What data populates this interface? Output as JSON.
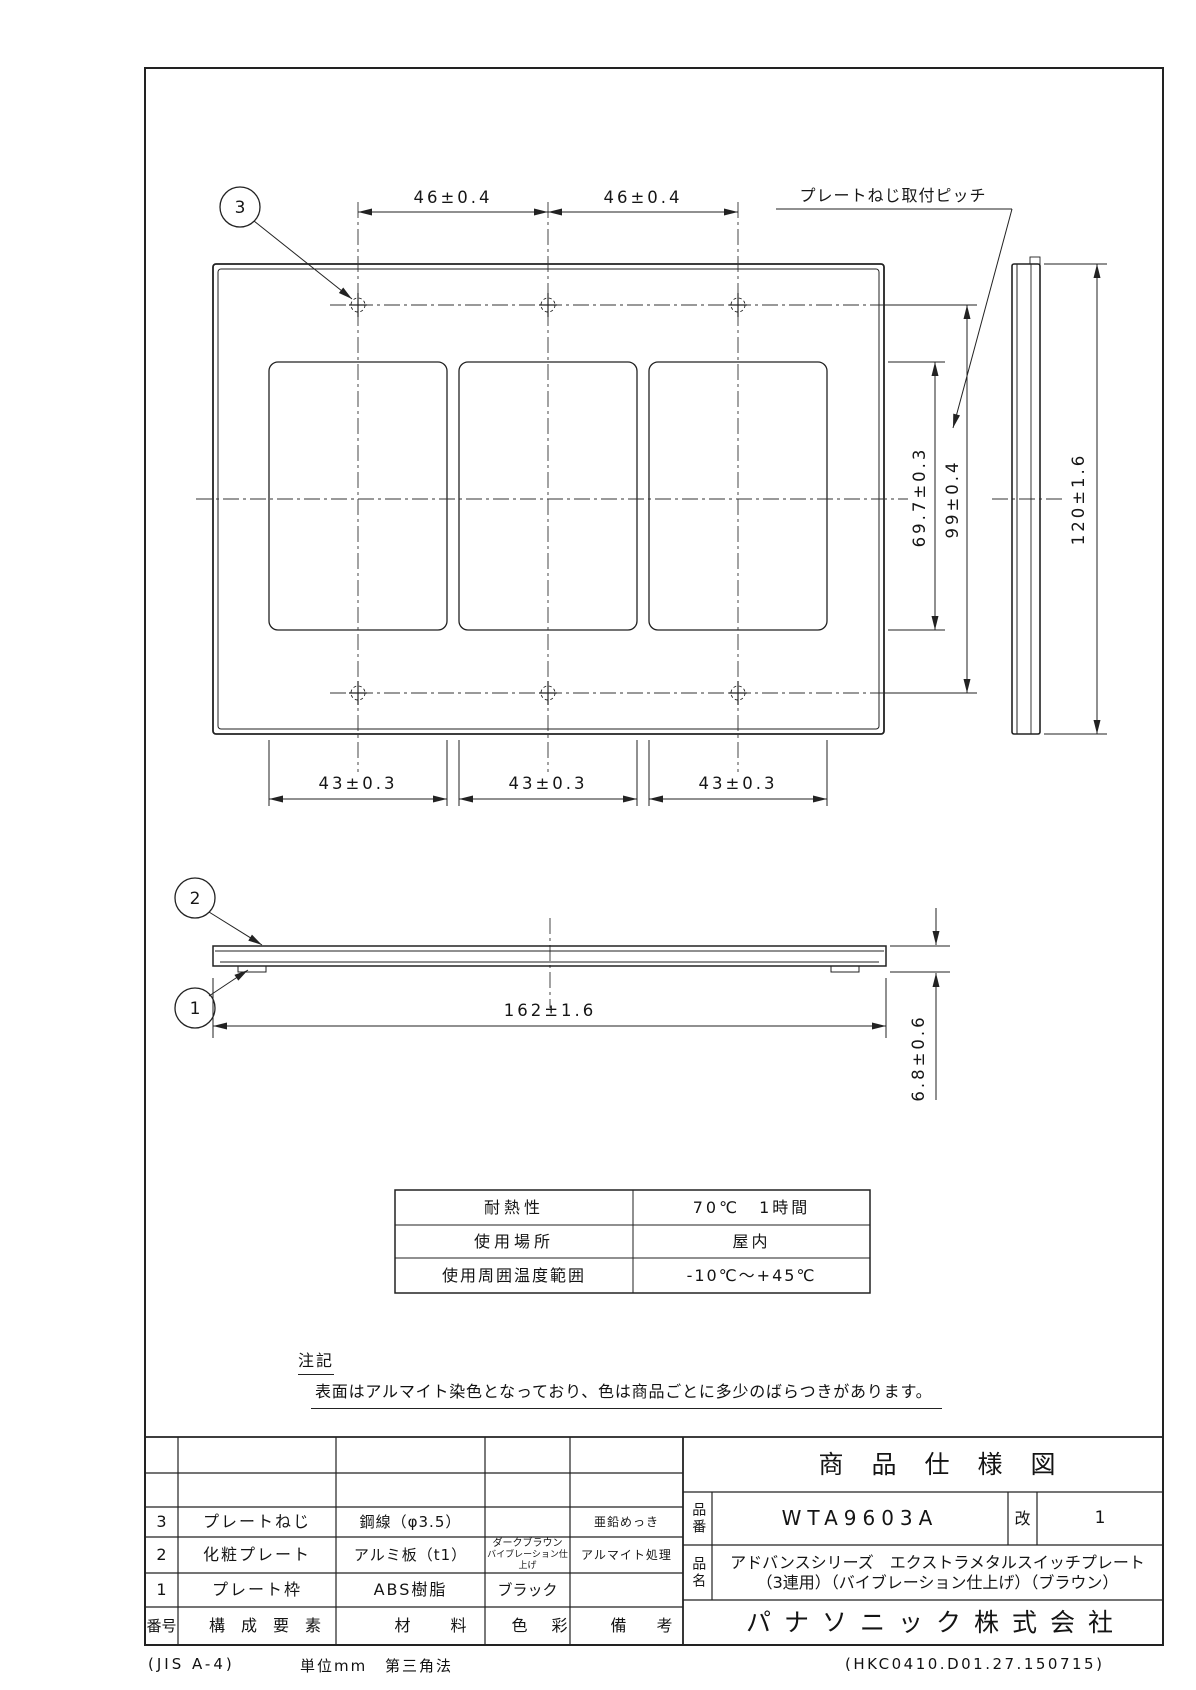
{
  "drawing": {
    "balloons": {
      "b3": "3",
      "b2": "2",
      "b1": "1"
    },
    "dims": {
      "pitch_left": "46±0.4",
      "pitch_right": "46±0.4",
      "screw_pitch_label": "プレートねじ取付ピッチ",
      "opening_height": "69.7±0.3",
      "screw_pitch_v": "99±0.4",
      "plate_height": "120±1.6",
      "opening_w1": "43±0.3",
      "opening_w2": "43±0.3",
      "opening_w3": "43±0.3",
      "plate_width": "162±1.6",
      "thickness": "6.8±0.6"
    }
  },
  "spec_table": {
    "rows": [
      {
        "label": "耐熱性",
        "value": "70℃　1時間"
      },
      {
        "label": "使用場所",
        "value": "屋内"
      },
      {
        "label": "使用周囲温度範囲",
        "value": "-10℃～+45℃"
      }
    ]
  },
  "note": {
    "label": "注記",
    "text": "表面はアルマイト染色となっており、色は商品ごとに多少のばらつきがあります。"
  },
  "title_block": {
    "title": "商品仕様図",
    "part_no_label": "品番",
    "part_no": "WTA9603A",
    "rev_label": "改",
    "rev": "1",
    "name_label": "品名",
    "name_line1": "アドバンスシリーズ　エクストラメタルスイッチプレート",
    "name_line2": "（3連用）（バイブレーション仕上げ）（ブラウン）",
    "company": "パナソニック株式会社"
  },
  "parts_table": {
    "header": {
      "no": "番号",
      "component": "構成要素",
      "material": "材料",
      "color": "色彩",
      "remarks": "備考"
    },
    "rows": [
      {
        "no": "3",
        "component": "プレートねじ",
        "material": "鋼線（φ3.5）",
        "color": "",
        "remarks": "亜鉛めっき"
      },
      {
        "no": "2",
        "component": "化粧プレート",
        "material": "アルミ板（t1）",
        "color_line1": "ダークブラウン",
        "color_line2": "バイブレーション仕上げ",
        "remarks": "アルマイト処理"
      },
      {
        "no": "1",
        "component": "プレート枠",
        "material": "ABS樹脂",
        "color": "ブラック",
        "remarks": ""
      }
    ]
  },
  "footer": {
    "standard": "(JIS A-4)",
    "unit": "単位mm",
    "projection": "第三角法",
    "code": "(HKC0410.D01.27.150715)"
  },
  "colors": {
    "line": "#222222",
    "background": "#ffffff"
  }
}
